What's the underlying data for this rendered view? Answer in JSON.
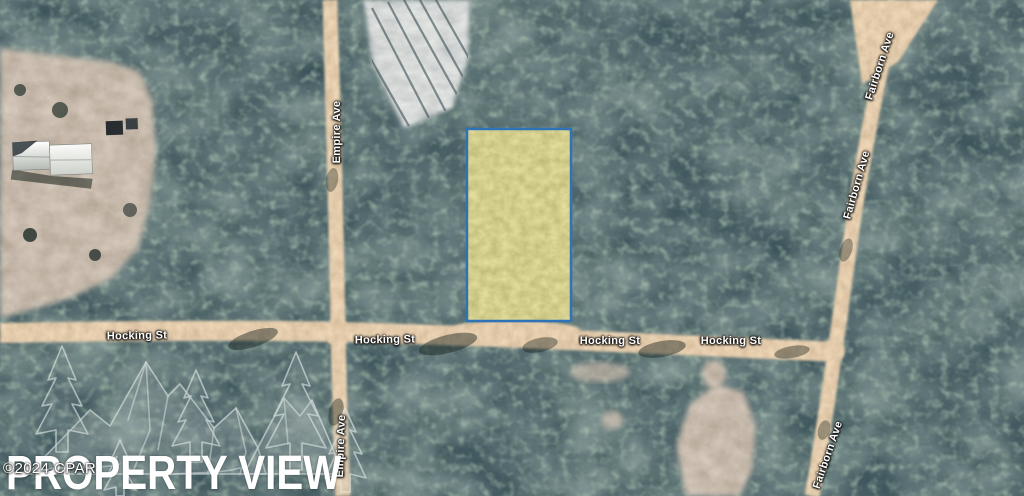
{
  "map": {
    "view": "aerial-satellite",
    "road_labels": {
      "hocking": "Hocking St",
      "empire": "Empire Ave",
      "fairborn": "Fairborn Ave"
    },
    "highlighted_parcel": {
      "shape": "rectangle",
      "fill_color": "#b0a24c",
      "border_color": "#2e73b8"
    },
    "terrain_colors": {
      "forest": "#1b2b2b",
      "dirt_road": "#c49a68",
      "clearing": "#8d7e6b",
      "logged_patch": "#a9aeae"
    }
  },
  "watermark": {
    "title": "PROPERTY VIEW",
    "copyright": "©2024 CPAR"
  }
}
